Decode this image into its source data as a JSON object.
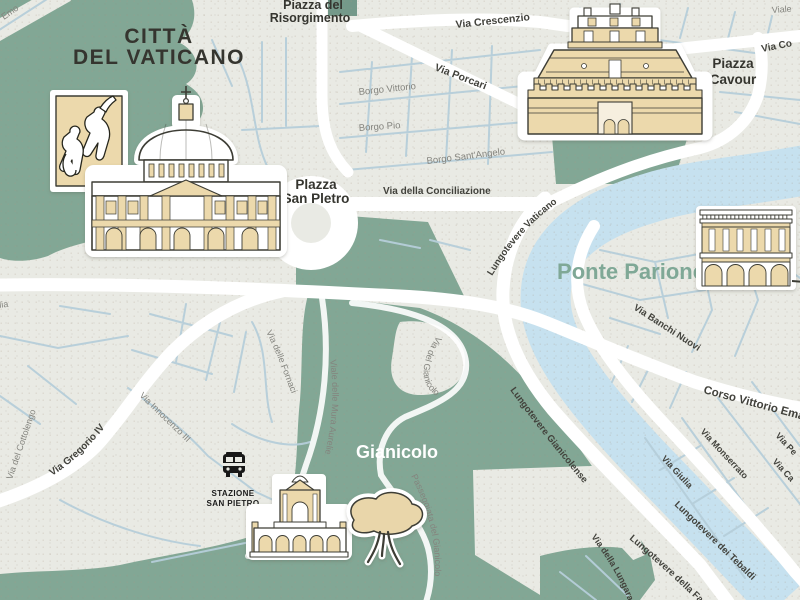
{
  "map": {
    "colors": {
      "background": "#e9eae4",
      "park_green": "#82a795",
      "river_blue": "#c6e1ef",
      "road_minor": "#b5cdd9",
      "road_major": "#ffffff",
      "building_fill": "#ecd9ac",
      "building_outline": "#3c3c34",
      "label_dark": "#42423c",
      "label_gray": "#84847e",
      "accent_green": "#7fa896"
    },
    "areas": {
      "vatican": {
        "line1": "CITTÀ",
        "line2": "DEL VATICANO"
      },
      "risorgimento": {
        "line1": "Piazza del",
        "line2": "Risorgimento"
      },
      "san_pietro": {
        "line1": "Plazza",
        "line2": "San Pletro"
      },
      "cavour": {
        "line1": "Piazza",
        "line2": "Cavour"
      },
      "ponte_parione": "Ponte Parione",
      "gianicolo": "Gianicolo"
    },
    "streets": {
      "emo": "Emo",
      "viale": "Viale",
      "via_co": "Via Co",
      "crescenzio": "Via Crescenzio",
      "porcari": "Via Porcari",
      "borgo_vittorio": "Borgo Vittorio",
      "borgo_pio": "Borgo Pio",
      "borgo_sant_angelo": "Borgo Sant'Angelo",
      "conciliazione": "Via della Conciliazione",
      "lungotevere_vaticano": "Lungotevere Vaticano",
      "banchi_nuovi": "Via Banchi Nuovi",
      "corso_vittorio": "Corso Vittorio Emanuele",
      "monserrato": "Via Monserrato",
      "giulia": "Via Giulia",
      "via_pe": "Via Pe",
      "via_ca": "Via Ca",
      "lungotevere_gianicolense": "Lungotevere Gianicolense",
      "lungotevere_tebaldi": "Lungotevere dei Tebaldi",
      "lungotevere_farnesina": "Lungotevere della Farnesina",
      "via_lungara": "Via della Lungara",
      "aurelia": "Via Aurelia",
      "gregorio": "Via Gregorio IV",
      "innocenzo": "Via Innocenzo III",
      "cottolengo": "Via del Cottolengo",
      "fornaci": "Via delle Fornaci",
      "mura_aurelie": "Viale delle Mura Aurelie",
      "via_gianicolo": "Via del Gianicolo",
      "passeggiata": "Passeggiata del Gianicolo"
    },
    "station": {
      "line1": "STAZIONE",
      "line2": "SAN PIETRO"
    },
    "landmarks": {
      "painting": "sistine-fresco-painting",
      "basilica": "st-peters-basilica",
      "castle": "castel-sant-angelo",
      "colonnade": "colonnade-building",
      "fountain": "fontana-acqua-paola",
      "tree": "stone-pine-tree",
      "station_icon": "train-station-icon"
    }
  }
}
